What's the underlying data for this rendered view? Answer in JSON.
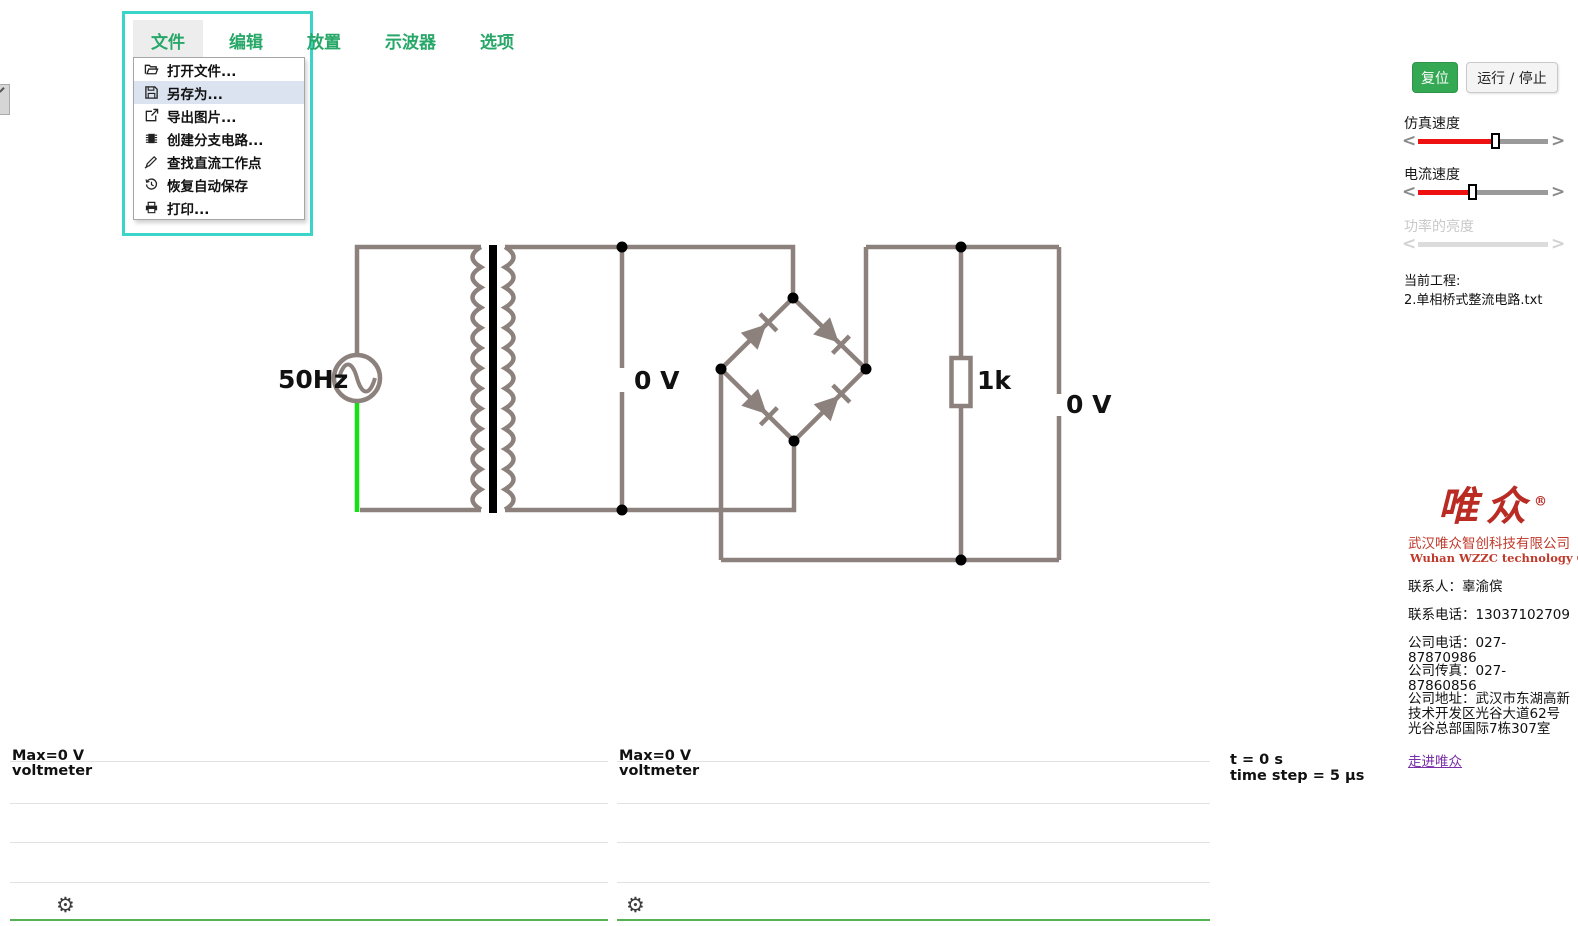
{
  "menu": {
    "items": [
      {
        "label": "文件",
        "active": true
      },
      {
        "label": "编辑",
        "active": false
      },
      {
        "label": "放置",
        "active": false
      },
      {
        "label": "示波器",
        "active": false
      },
      {
        "label": "选项",
        "active": false
      }
    ],
    "dropdown": [
      {
        "icon": "folder-open-icon",
        "label": "打开文件...",
        "highlighted": false
      },
      {
        "icon": "save-icon",
        "label": "另存为...",
        "highlighted": true
      },
      {
        "icon": "export-image-icon",
        "label": "导出图片...",
        "highlighted": false
      },
      {
        "icon": "chip-icon",
        "label": "创建分支电路...",
        "highlighted": false
      },
      {
        "icon": "pencil-icon",
        "label": "查找直流工作点",
        "highlighted": false
      },
      {
        "icon": "history-icon",
        "label": "恢复自动保存",
        "highlighted": false
      },
      {
        "icon": "printer-icon",
        "label": "打印...",
        "highlighted": false
      }
    ]
  },
  "toolbar": {
    "reset_label": "复位",
    "run_stop_label": "运行 / 停止"
  },
  "sliders": [
    {
      "label": "仿真速度",
      "value": 60,
      "disabled": false
    },
    {
      "label": "电流速度",
      "value": 42,
      "disabled": false
    },
    {
      "label": "功率的亮度",
      "value": 0,
      "disabled": true
    }
  ],
  "project": {
    "heading": "当前工程:",
    "filename": "2.单相桥式整流电路.txt"
  },
  "company": {
    "logo_text": "唯众",
    "logo_reg": "®",
    "name_cn": "武汉唯众智创科技有限公司",
    "name_en": "Wuhan WZZC technology Con.,Ltd",
    "contact_person": "联系人：辜渝傧",
    "contact_phone": "联系电话：13037102709",
    "company_phone": "公司电话：027-87870986",
    "company_fax": "公司传真：027-87860856",
    "company_address": "公司地址：武汉市东湖高新技术开发区光谷大道62号光谷总部国际7栋307室",
    "link_label": "走进唯众"
  },
  "circuit": {
    "source_label": "50Hz",
    "voltmeter1_label": "0 V",
    "resistor_label": "1k",
    "voltmeter2_label": "0 V"
  },
  "scopes": [
    {
      "max_label": "Max=0 V",
      "name": "voltmeter"
    },
    {
      "max_label": "Max=0 V",
      "name": "voltmeter"
    }
  ],
  "status": {
    "time": "t = 0 s",
    "step": "time step = 5 µs"
  },
  "colors": {
    "menu_green": "#27a768",
    "highlight_teal": "#3bd4c9",
    "reset_button_green": "#34a853",
    "slider_red": "#ee1111",
    "wire_gray": "#8c817c",
    "wire_green": "#14e014",
    "scope_trace_green": "#54b254",
    "logo_red": "#b92b23",
    "link_purple": "#7b2fa8"
  }
}
